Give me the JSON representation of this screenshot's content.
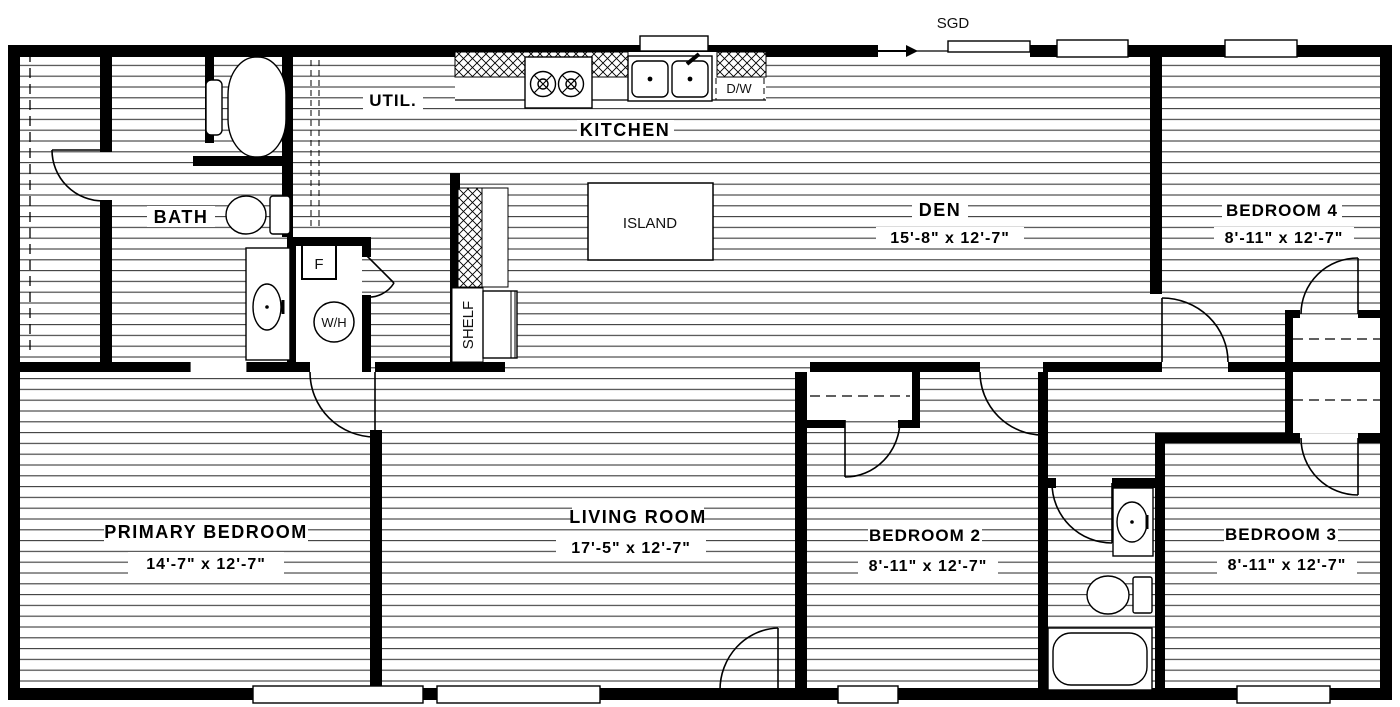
{
  "colors": {
    "wall": "#000000",
    "floor_line": "#3a3a3a",
    "background": "#ffffff"
  },
  "rooms": {
    "util": {
      "name": "UTIL."
    },
    "kitchen": {
      "name": "KITCHEN"
    },
    "bath": {
      "name": "BATH"
    },
    "den": {
      "name": "DEN",
      "dims": "15'-8\" x  12'-7\""
    },
    "bedroom4": {
      "name": "BEDROOM 4",
      "dims": "8'-11\" x  12'-7\""
    },
    "primary": {
      "name": "PRIMARY BEDROOM",
      "dims": "14'-7\" x  12'-7\""
    },
    "living": {
      "name": "LIVING ROOM",
      "dims": "17'-5\" x  12'-7\""
    },
    "bedroom2": {
      "name": "BEDROOM 2",
      "dims": "8'-11\" x  12'-7\""
    },
    "bedroom3": {
      "name": "BEDROOM 3",
      "dims": "8'-11\" x  12'-7\""
    }
  },
  "features": {
    "sliding_glass_door": "SGD",
    "island": "ISLAND",
    "shelf": "SHELF",
    "dishwasher": "D/W",
    "freezer": "F",
    "water_heater": "W/H"
  }
}
